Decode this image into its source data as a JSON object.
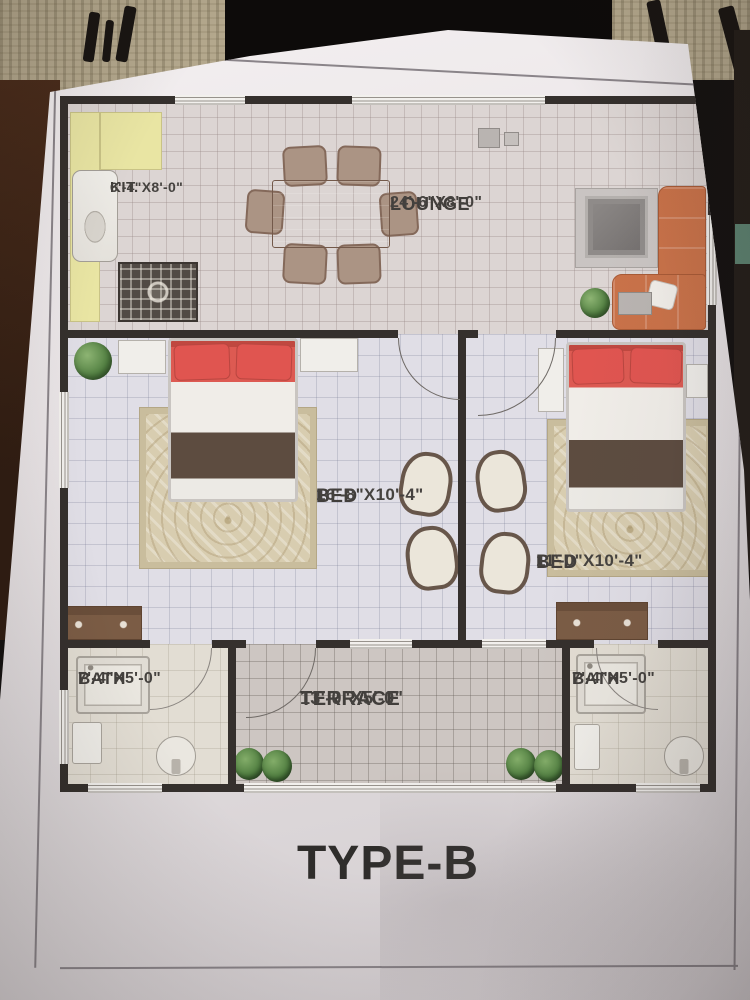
{
  "plan": {
    "title": "TYPE-B",
    "rooms": {
      "kitchen": {
        "name": "KIT.",
        "dims": "6'-4\"X8'-0\""
      },
      "lounge": {
        "name": "LOUNGE",
        "dims": "24'-6\"X8'-0\""
      },
      "bed_left": {
        "name": "BED",
        "dims": "16'-8\"X10'-4\""
      },
      "bed_right": {
        "name": "BED",
        "dims": "11'-0\"X10'-4\""
      },
      "bath_left": {
        "name": "BATH",
        "dims": "7'-4\"X5'-0\""
      },
      "bath_right": {
        "name": "BATH",
        "dims": "7'-4\"X5'-0\""
      },
      "terrace": {
        "name": "TERRACE",
        "dims": "13'-0\"X5'-0\""
      }
    }
  },
  "colors": {
    "wall": "#35302d",
    "kitchen_counter": "#e9e5a3",
    "sofa": "#c97249",
    "bed_pillow": "#dd5a52",
    "bed_blanket": "#5d4c40",
    "rug": "#d7cbae",
    "plant": "#4f7d3f",
    "lounge_floor": "#dcd5d3",
    "bedroom_floor": "#e0dee6",
    "terrace_floor": "#cdc6c2",
    "bath_floor": "#e2ddd3",
    "label_text": "#413e3b"
  }
}
